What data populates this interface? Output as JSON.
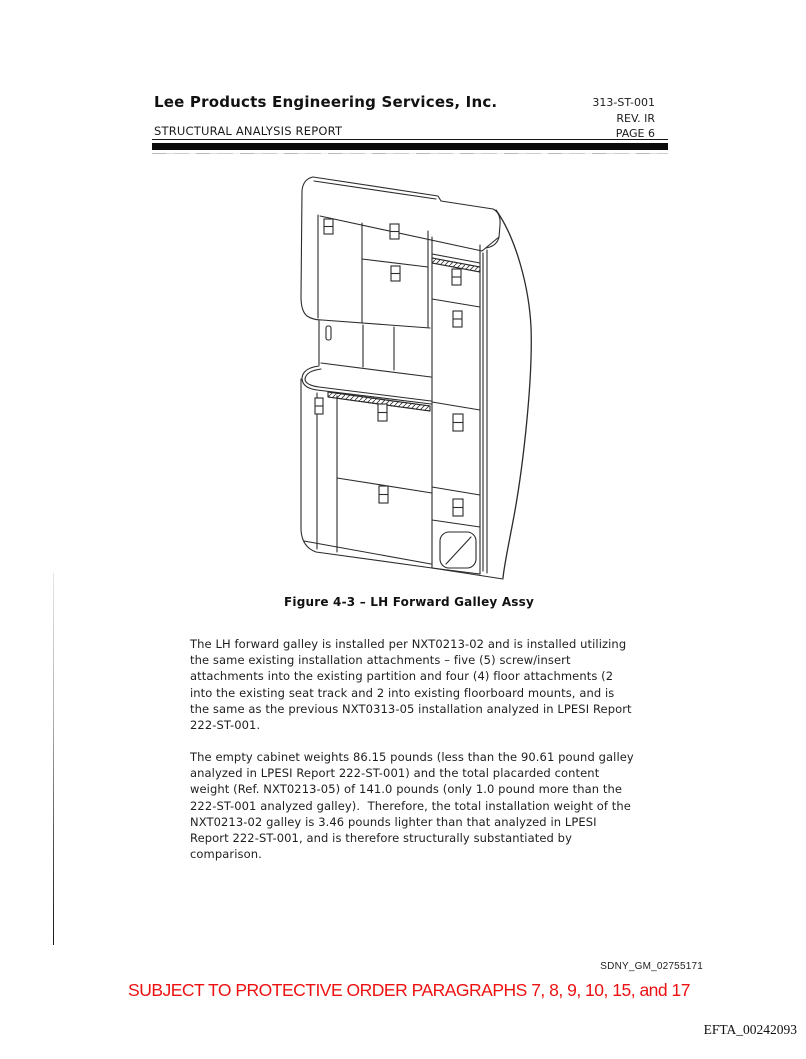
{
  "header": {
    "company": "Lee Products Engineering Services, Inc.",
    "report_type": "STRUCTURAL ANALYSIS REPORT",
    "doc_number": "313-ST-001",
    "revision": "REV. IR",
    "page_label": "PAGE 6"
  },
  "figure": {
    "caption": "Figure 4-3 – LH Forward Galley Assy",
    "drawing": "isometric line drawing of the LH forward galley cabinet assembly with compartment doors, latches, work counter rail and waste door"
  },
  "body": {
    "paragraph1": "The LH forward galley is installed per NXT0213-02 and is installed utilizing\nthe same existing installation attachments – five (5) screw/insert\nattachments into the existing partition and four (4) floor attachments (2\ninto the existing seat track and 2 into existing floorboard mounts, and is\nthe same as the previous NXT0313-05 installation analyzed in LPESI Report\n222-ST-001.",
    "paragraph2": "The empty cabinet weights 86.15 pounds (less than the 90.61 pound galley\nanalyzed in LPESI Report 222-ST-001) and the total placarded content\nweight (Ref. NXT0213-05) of 141.0 pounds (only 1.0 pound more than the\n222-ST-001 analyzed galley).  Therefore, the total installation weight of the\nNXT0213-02 galley is 3.46 pounds lighter than that analyzed in LPESI\nReport 222-ST-001, and is therefore structurally substantiated by\ncomparison."
  },
  "stamps": {
    "bates_top": "SDNY_GM_02755171",
    "protective_order": "SUBJECT TO PROTECTIVE ORDER PARAGRAPHS 7, 8, 9, 10, 15, and 17",
    "bates_bottom": "EFTA_00242093"
  },
  "colors": {
    "protective_order_red": "#ee1111",
    "ink": "#1a1a1a"
  }
}
